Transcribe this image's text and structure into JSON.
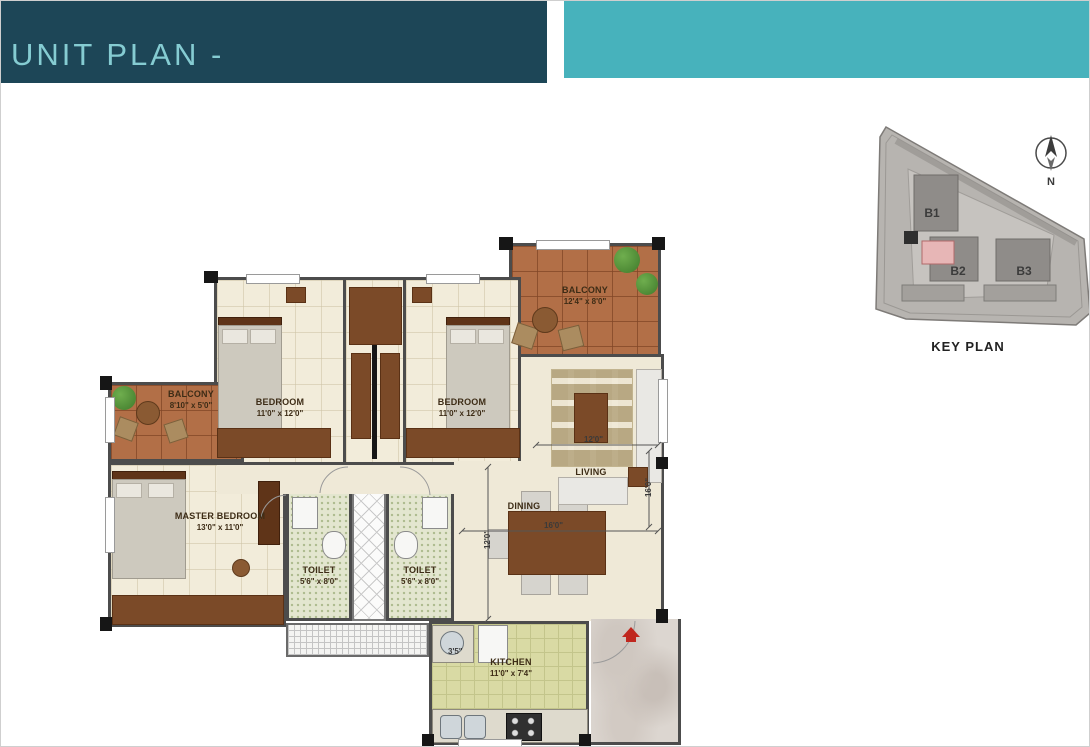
{
  "header": {
    "title": "UNIT PLAN -"
  },
  "colors": {
    "header_dark": "#1d4657",
    "header_teal": "#47b2bc",
    "header_text": "#85ccd2",
    "wall": "#4c4c4c",
    "balcony_tile": "#b26f47",
    "wood": "#7b4a28",
    "highlight_pink": "#e7b6b6",
    "entry_red": "#c0271e"
  },
  "floor_plan": {
    "rooms": [
      {
        "id": "balcony-top",
        "name": "BALCONY",
        "dim": "12'4\" x 8'0\""
      },
      {
        "id": "bedroom-1",
        "name": "BEDROOM",
        "dim": "11'0\" x 12'0\""
      },
      {
        "id": "bedroom-2",
        "name": "BEDROOM",
        "dim": "11'0\" x 12'0\""
      },
      {
        "id": "balcony-left",
        "name": "BALCONY",
        "dim": "8'10\" x 5'0\""
      },
      {
        "id": "master-bedroom",
        "name": "MASTER BEDROOM",
        "dim": "13'0\" x 11'0\""
      },
      {
        "id": "toilet-1",
        "name": "TOILET",
        "dim": "5'6\" x 8'0\""
      },
      {
        "id": "toilet-2",
        "name": "TOILET",
        "dim": "5'6\" x 8'0\""
      },
      {
        "id": "dining",
        "name": "DINING"
      },
      {
        "id": "living",
        "name": "LIVING"
      },
      {
        "id": "kitchen",
        "name": "KITCHEN",
        "dim": "11'0\" x 7'4\""
      }
    ],
    "dimensions": {
      "dining_width": "16'0\"",
      "living_width": "12'0\"",
      "dining_depth": "12'0\"",
      "living_side": "16'0\"",
      "kitchen_clearance": "3'5\""
    }
  },
  "key_plan": {
    "title": "KEY PLAN",
    "compass_label": "N",
    "blocks": [
      {
        "label": "B1"
      },
      {
        "label": "B2"
      },
      {
        "label": "B3"
      }
    ]
  }
}
